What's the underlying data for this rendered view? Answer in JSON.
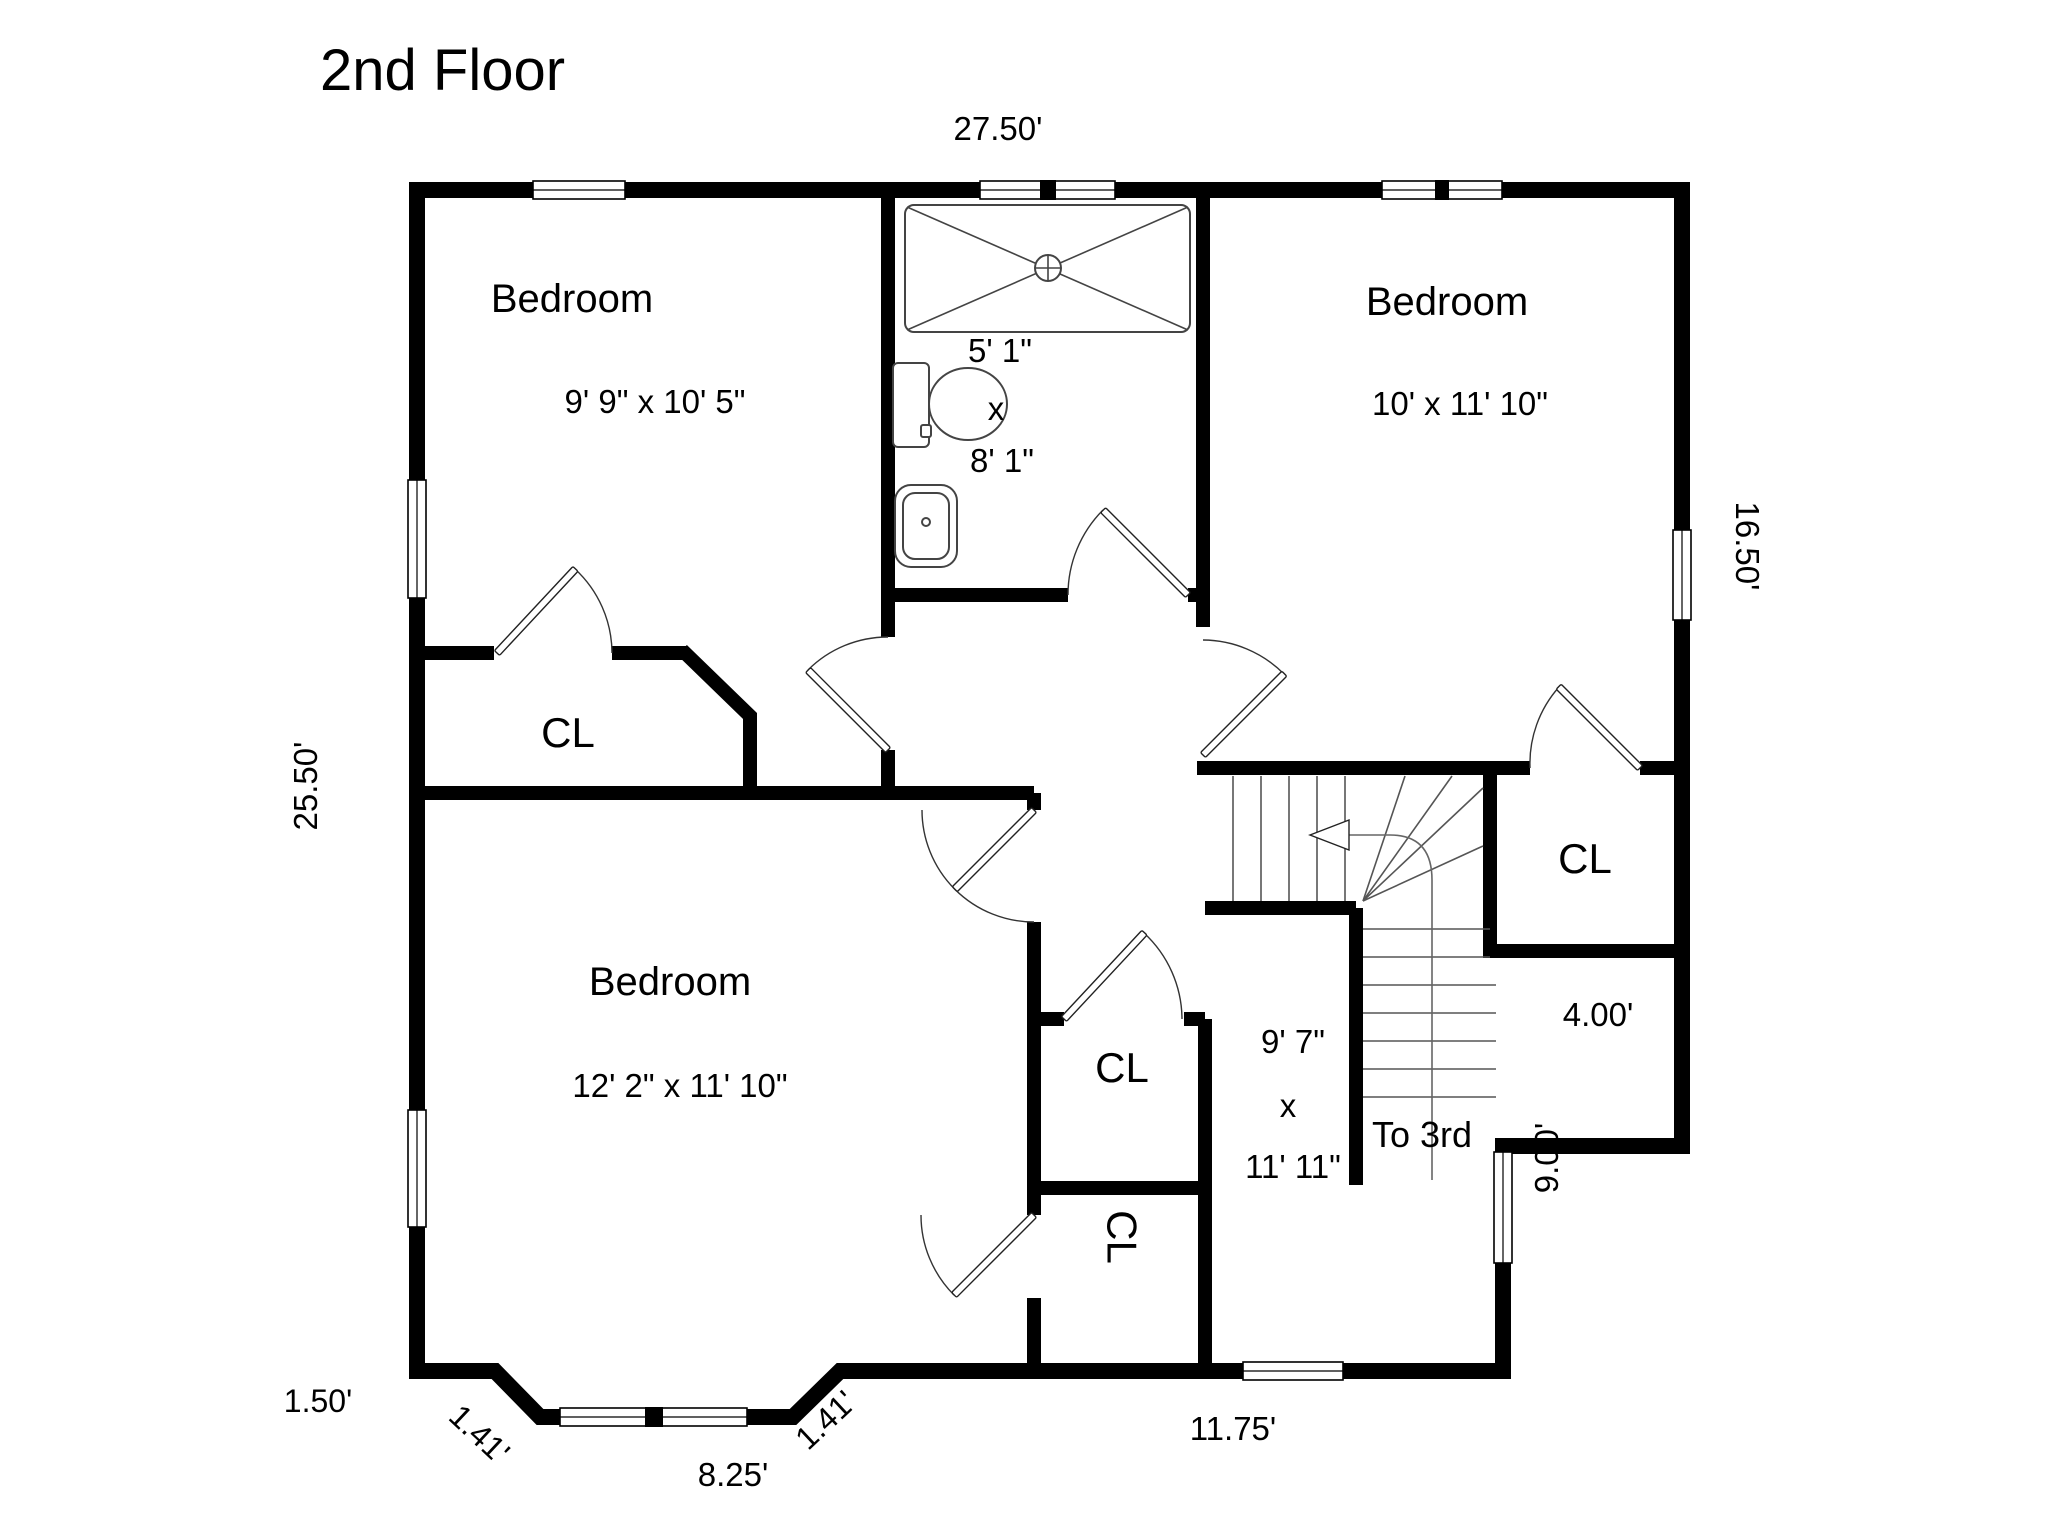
{
  "title": "2nd Floor",
  "rooms": {
    "bedroom_top_left": {
      "name": "Bedroom",
      "dims": "9' 9\" x 10' 5\""
    },
    "bedroom_top_right": {
      "name": "Bedroom",
      "dims": "10' x 11' 10\""
    },
    "bedroom_bottom_left": {
      "name": "Bedroom",
      "dims": "12' 2\" x 11' 10\""
    },
    "bathroom": {
      "width": "5' 1\"",
      "sep": "x",
      "length": "8' 1\""
    },
    "hall": {
      "width": "9' 7\"",
      "sep": "x",
      "length": "11' 11\""
    },
    "stairs": {
      "note": "To 3rd"
    }
  },
  "closets": {
    "cl_top_left": "CL",
    "cl_right": "CL",
    "cl_middle_upper": "CL",
    "cl_middle_lower": "CL"
  },
  "dimensions": {
    "top": "27.50'",
    "left": "25.50'",
    "right": "16.50'",
    "inner_right": "9.00'",
    "closet_width": "4.00'",
    "bottom_right": "11.75'",
    "bay_width": "8.25'",
    "bay_left_stub": "1.50'",
    "bay_diag_left": "1.41'",
    "bay_diag_right": "1.41'"
  }
}
